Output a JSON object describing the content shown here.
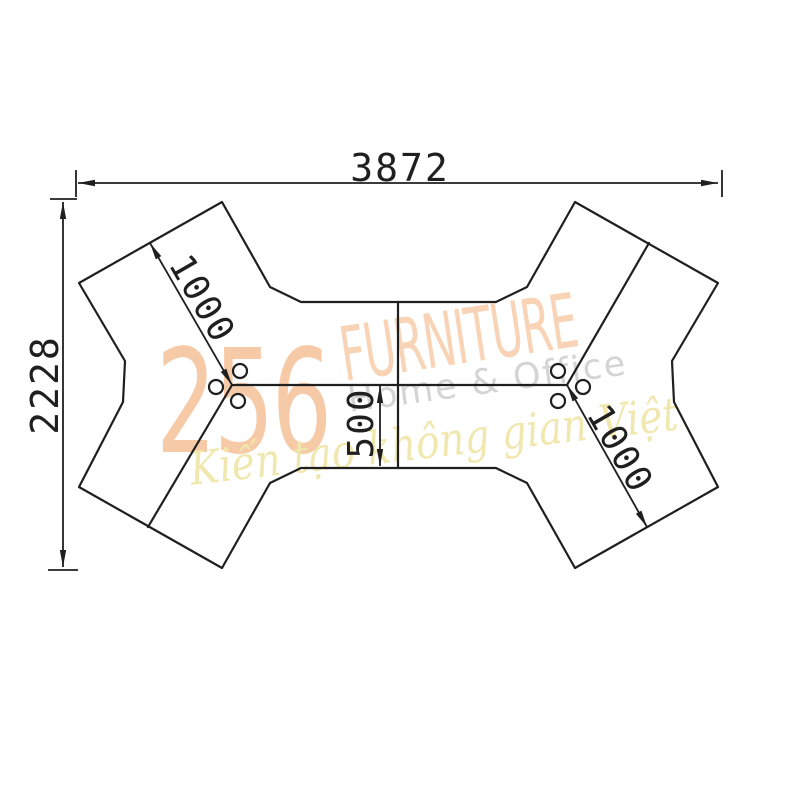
{
  "drawing": {
    "line_color": "#1f1f1f",
    "labels": {
      "total_width": "3872",
      "total_height": "2228",
      "left_wing_depth": "1000",
      "right_wing_depth": "1000",
      "center_depth": "500"
    }
  },
  "watermark": {
    "number": "256",
    "brand": "FURNITURE",
    "subtitle": "Home & Office",
    "slogan": "Kiến tạo không gian Việt",
    "number_color": "#f5be94",
    "brand_color": "#f8cba8",
    "subtitle_color": "#d2d2d2",
    "slogan_color": "#f0e7ac"
  }
}
